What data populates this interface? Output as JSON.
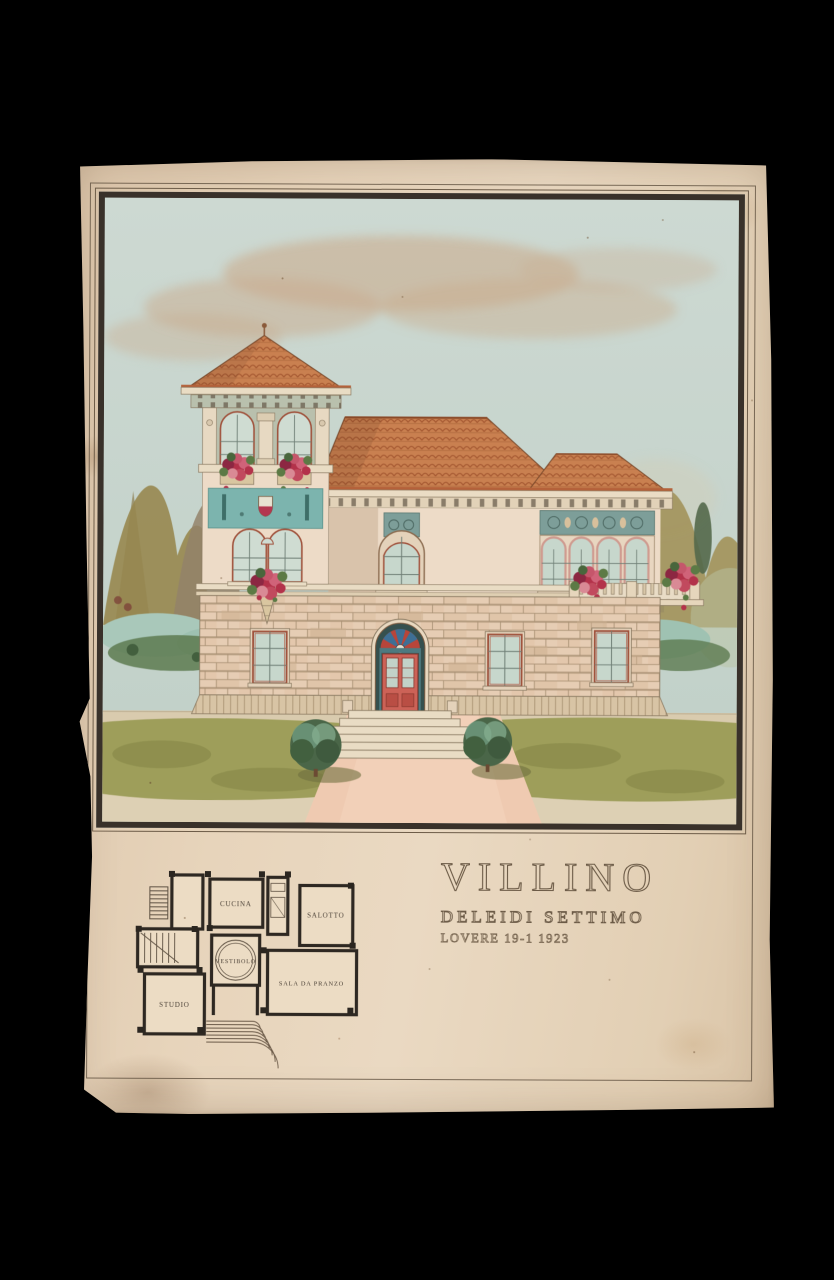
{
  "photograph": {
    "subject": "Watercolour architectural presentation drawing of a villa: front elevation with corner tower, terracotta tile roofs, rusticated stone ground floor, arched windows, flower-decked balconies, garden path with two topiary bushes, plus a ground-floor plan and hand-lettered title"
  },
  "title_block": {
    "title": "VILLINO",
    "subtitle": "DELEIDI  SETTIMO",
    "place_date": "LOVERE  19-1  1923"
  },
  "floor_plan": {
    "rooms": [
      {
        "label": "CUCINA"
      },
      {
        "label": "SALOTTO"
      },
      {
        "label": "VESTIBOLO"
      },
      {
        "label": "SALA DA PRANZO"
      },
      {
        "label": "STUDIO"
      }
    ]
  },
  "colors": {
    "background": "#000000",
    "paper": "#e5d2b9",
    "ink": "#5f5243",
    "frame_band": "#39312a",
    "sky": "#c7d5cd",
    "cloud": "#c9ab8c",
    "roof_tile": "#c97f51",
    "wall": "#ecdbc7",
    "stone": "#e2c9ae",
    "panel_teal": "#7cb4ae",
    "flowers": "#b3324a",
    "foliage": "#5d7a4a",
    "lawn": "#9a9b55",
    "path": "#efcab1"
  }
}
